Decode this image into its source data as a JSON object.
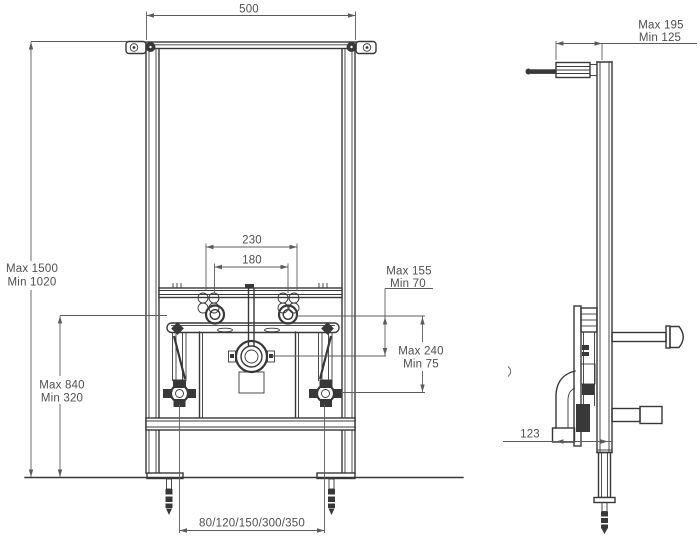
{
  "title": "Bidet installation frame technical drawing",
  "front_view": {
    "dims": {
      "width": "500",
      "height_total_max": "Max 1500",
      "height_total_min": "Min 1020",
      "height_lower_max": "Max 840",
      "height_lower_min": "Min 320",
      "bolt_spacing_outer": "230",
      "bolt_spacing_inner": "180",
      "right_upper_max": "Max 155",
      "right_upper_min": "Min 70",
      "right_lower_max": "Max 240",
      "right_lower_min": "Min 75",
      "water_spacing_options": "80/120/150/300/350"
    }
  },
  "side_view": {
    "dims": {
      "wall_distance_max": "Max 195",
      "wall_distance_min": "Min 125",
      "drain_offset": "123"
    }
  },
  "colors": {
    "line": "#383838",
    "dimension": "#5c5c5c",
    "text": "#4f4f4f",
    "background": "#ffffff"
  }
}
